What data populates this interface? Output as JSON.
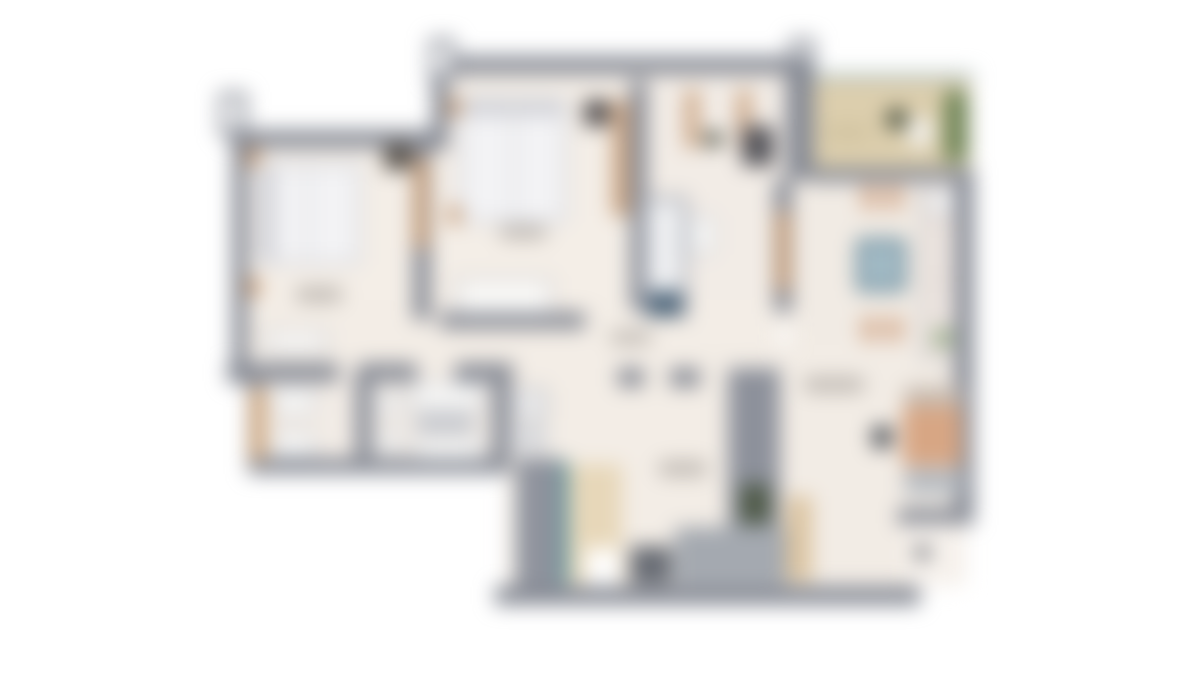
{
  "meta": {
    "description": "Heavily blurred top-down architectural floor plan of an apartment (2 bedrooms, 2 bathrooms, shower room, kitchen-dining, living area, entry hall, balcony). No legible text; room labels appear only as faint smudges.",
    "canvas_width": 1200,
    "canvas_height": 675,
    "background": "#ffffff",
    "blur_px": 10
  },
  "palette": {
    "wall_gray": "#878b95",
    "wall_gray_light": "#a4a9b0",
    "floor_cream": "#f3ede6",
    "balcony_tan": "#dccead",
    "wood_tan": "#c59a74",
    "cabinet_beige": "#e7d7b9",
    "plant_green": "#6d8355",
    "dark_green": "#4f5a48",
    "table_blue": "#6f8fa0",
    "teal_glass": "#4f8f96",
    "sofa_salmon": "#d7a684",
    "fixture_white": "#f7f7f6",
    "label_smudge": "#bdb7b1"
  },
  "floorplan": {
    "regions": [
      {
        "name": "bedroom-1-floor",
        "x": 232,
        "y": 132,
        "w": 200,
        "h": 246,
        "color": "#f4eee7"
      },
      {
        "name": "bedroom-2-floor",
        "x": 432,
        "y": 58,
        "w": 382,
        "h": 268,
        "color": "#f4eee7"
      },
      {
        "name": "shower-room-floor",
        "x": 640,
        "y": 82,
        "w": 150,
        "h": 230,
        "color": "#f2ece6"
      },
      {
        "name": "kitchen-floor",
        "x": 790,
        "y": 168,
        "w": 168,
        "h": 217,
        "color": "#f1ebe4"
      },
      {
        "name": "hallway-floor",
        "x": 246,
        "y": 300,
        "w": 534,
        "h": 85,
        "color": "#f3ede6"
      },
      {
        "name": "bathrooms-floor",
        "x": 250,
        "y": 372,
        "w": 306,
        "h": 100,
        "color": "#f2ece6"
      },
      {
        "name": "utility-floor",
        "x": 505,
        "y": 375,
        "w": 115,
        "h": 212,
        "color": "#f3ede6"
      },
      {
        "name": "entry-hall-floor",
        "x": 560,
        "y": 327,
        "w": 220,
        "h": 260,
        "color": "#f3ede6"
      },
      {
        "name": "living-room-floor",
        "x": 700,
        "y": 345,
        "w": 266,
        "h": 240,
        "color": "#f2ece5"
      },
      {
        "name": "balcony-glass-rail",
        "x": 808,
        "y": 72,
        "w": 166,
        "h": 10,
        "color": "#b8c7c7"
      },
      {
        "name": "balcony-floor",
        "x": 810,
        "y": 80,
        "w": 160,
        "h": 90,
        "color": "#dccead"
      },
      {
        "name": "balcony-plant-strip",
        "x": 944,
        "y": 90,
        "w": 24,
        "h": 72,
        "color": "#6d8355",
        "radius": 8
      },
      {
        "name": "balcony-plant-pot",
        "x": 886,
        "y": 108,
        "w": 22,
        "h": 22,
        "color": "#49513e",
        "radius": "50%"
      },
      {
        "name": "balcony-chair",
        "x": 908,
        "y": 118,
        "w": 24,
        "h": 28,
        "color": "#f2f1ed",
        "radius": 6
      },
      {
        "name": "balcony-label-smudge",
        "x": 826,
        "y": 126,
        "w": 44,
        "h": 13,
        "color": "#cfc19e",
        "radius": 6
      },
      {
        "name": "wall-top-bedroom-1",
        "x": 230,
        "y": 130,
        "w": 206,
        "h": 18,
        "color": "#878b95"
      },
      {
        "name": "wall-left-exterior",
        "x": 232,
        "y": 132,
        "w": 16,
        "h": 252,
        "color": "#878b95"
      },
      {
        "name": "wall-post-top-left",
        "x": 219,
        "y": 92,
        "w": 28,
        "h": 44,
        "color": "#878b95"
      },
      {
        "name": "wall-post-top-left-cap",
        "x": 225,
        "y": 98,
        "w": 15,
        "h": 31,
        "color": "#ffffff"
      },
      {
        "name": "wall-top-bedroom-2",
        "x": 432,
        "y": 56,
        "w": 382,
        "h": 18,
        "color": "#878b95"
      },
      {
        "name": "wall-step-top",
        "x": 432,
        "y": 56,
        "w": 16,
        "h": 94,
        "color": "#878b95"
      },
      {
        "name": "wall-post-top-mid",
        "x": 429,
        "y": 38,
        "w": 26,
        "h": 44,
        "color": "#878b95"
      },
      {
        "name": "wall-post-top-mid-cap",
        "x": 435,
        "y": 44,
        "w": 14,
        "h": 30,
        "color": "#ffffff"
      },
      {
        "name": "wall-post-top-right",
        "x": 789,
        "y": 38,
        "w": 26,
        "h": 44,
        "color": "#878b95"
      },
      {
        "name": "wall-post-top-right-cap",
        "x": 795,
        "y": 44,
        "w": 14,
        "h": 30,
        "color": "#ffffff"
      },
      {
        "name": "wall-block-balcony-left",
        "x": 786,
        "y": 56,
        "w": 28,
        "h": 124,
        "color": "#878b95"
      },
      {
        "name": "wall-under-balcony",
        "x": 810,
        "y": 168,
        "w": 164,
        "h": 14,
        "color": "#878b95"
      },
      {
        "name": "wall-right-kitchen",
        "x": 954,
        "y": 168,
        "w": 20,
        "h": 220,
        "color": "#878b95"
      },
      {
        "name": "wall-bedroom-1-right",
        "x": 413,
        "y": 135,
        "w": 18,
        "h": 185,
        "color": "#878b95"
      },
      {
        "name": "wall-bedroom-2-right",
        "x": 630,
        "y": 80,
        "w": 17,
        "h": 230,
        "color": "#878b95"
      },
      {
        "name": "wall-bedroom-2-bottom",
        "x": 440,
        "y": 312,
        "w": 145,
        "h": 17,
        "color": "#878b95"
      },
      {
        "name": "wall-shower-room-right",
        "x": 774,
        "y": 180,
        "w": 18,
        "h": 132,
        "color": "#878b95"
      },
      {
        "name": "wall-bathrooms-top-a",
        "x": 227,
        "y": 363,
        "w": 112,
        "h": 19,
        "color": "#878b95"
      },
      {
        "name": "wall-bathrooms-top-b",
        "x": 359,
        "y": 363,
        "w": 58,
        "h": 19,
        "color": "#878b95"
      },
      {
        "name": "wall-bathrooms-top-c",
        "x": 455,
        "y": 363,
        "w": 58,
        "h": 19,
        "color": "#878b95"
      },
      {
        "name": "wall-bathrooms-left",
        "x": 248,
        "y": 370,
        "w": 14,
        "h": 104,
        "color": "#878b95"
      },
      {
        "name": "wall-bathroom-divider",
        "x": 355,
        "y": 370,
        "w": 17,
        "h": 100,
        "color": "#878b95"
      },
      {
        "name": "wall-bathroom-2-right",
        "x": 492,
        "y": 370,
        "w": 18,
        "h": 100,
        "color": "#878b95"
      },
      {
        "name": "wall-bathrooms-bottom",
        "x": 248,
        "y": 458,
        "w": 262,
        "h": 16,
        "color": "#878b95"
      },
      {
        "name": "wall-hall-living-a",
        "x": 618,
        "y": 368,
        "w": 26,
        "h": 19,
        "color": "#878b95"
      },
      {
        "name": "wall-hall-living-b",
        "x": 670,
        "y": 368,
        "w": 30,
        "h": 19,
        "color": "#878b95"
      },
      {
        "name": "wall-entry-living-thick",
        "x": 728,
        "y": 368,
        "w": 52,
        "h": 215,
        "color": "#8d919b"
      },
      {
        "name": "stairs-blob",
        "x": 675,
        "y": 527,
        "w": 112,
        "h": 58,
        "color": "#a4a9b0"
      },
      {
        "name": "duct-shaft",
        "x": 516,
        "y": 458,
        "w": 46,
        "h": 130,
        "color": "#8f939d"
      },
      {
        "name": "wall-bottom-main",
        "x": 495,
        "y": 586,
        "w": 425,
        "h": 19,
        "color": "#878b95"
      },
      {
        "name": "wall-living-right",
        "x": 954,
        "y": 385,
        "w": 20,
        "h": 140,
        "color": "#878b95"
      },
      {
        "name": "wall-living-bottom-right",
        "x": 898,
        "y": 508,
        "w": 76,
        "h": 17,
        "color": "#878b95"
      },
      {
        "name": "living-notch-floor",
        "x": 904,
        "y": 524,
        "w": 60,
        "h": 62,
        "color": "#f6f1ec"
      },
      {
        "name": "bed-1",
        "x": 256,
        "y": 162,
        "w": 106,
        "h": 104,
        "color": "#dcdde1",
        "radius": 6
      },
      {
        "name": "bed-1-duvet",
        "x": 262,
        "y": 168,
        "w": 94,
        "h": 92,
        "color": "#f3f3f5"
      },
      {
        "name": "bed-1-pillow-band",
        "x": 262,
        "y": 168,
        "w": 13,
        "h": 92,
        "color": "#cfd0d6"
      },
      {
        "name": "bed-1-center-seam",
        "x": 306,
        "y": 168,
        "w": 3,
        "h": 92,
        "color": "#d5d6da"
      },
      {
        "name": "nightstand-1a",
        "x": 246,
        "y": 148,
        "w": 14,
        "h": 18,
        "color": "#c59a74"
      },
      {
        "name": "nightstand-1b",
        "x": 246,
        "y": 278,
        "w": 14,
        "h": 18,
        "color": "#c59a74"
      },
      {
        "name": "wardrobe-1-dark",
        "x": 384,
        "y": 144,
        "w": 28,
        "h": 26,
        "color": "#5a544d"
      },
      {
        "name": "door-1-leaf",
        "x": 414,
        "y": 158,
        "w": 14,
        "h": 90,
        "color": "#c59a74"
      },
      {
        "name": "bedroom-1-label-smudge",
        "x": 295,
        "y": 287,
        "w": 48,
        "h": 15,
        "color": "#bdb7b1",
        "radius": 8
      },
      {
        "name": "dresser-1",
        "x": 265,
        "y": 330,
        "w": 62,
        "h": 22,
        "color": "#fbfaf8",
        "border": "2px solid #a9acb4"
      },
      {
        "name": "bed-2",
        "x": 458,
        "y": 96,
        "w": 110,
        "h": 128,
        "color": "#dcdde1",
        "radius": 6
      },
      {
        "name": "bed-2-duvet",
        "x": 464,
        "y": 102,
        "w": 98,
        "h": 116,
        "color": "#f3f3f5"
      },
      {
        "name": "bed-2-pillow-band",
        "x": 464,
        "y": 102,
        "w": 98,
        "h": 14,
        "color": "#cfd0d6"
      },
      {
        "name": "bed-2-center-seam",
        "x": 512,
        "y": 102,
        "w": 3,
        "h": 116,
        "color": "#d5d6da"
      },
      {
        "name": "nightstand-2a",
        "x": 448,
        "y": 98,
        "w": 13,
        "h": 18,
        "color": "#c59a74"
      },
      {
        "name": "nightstand-2b",
        "x": 448,
        "y": 206,
        "w": 13,
        "h": 18,
        "color": "#c59a74"
      },
      {
        "name": "media-unit-2-dark",
        "x": 584,
        "y": 100,
        "w": 26,
        "h": 26,
        "color": "#545051"
      },
      {
        "name": "wardrobe-2-wood",
        "x": 612,
        "y": 100,
        "w": 18,
        "h": 116,
        "color": "#caa584"
      },
      {
        "name": "bedroom-2-label-smudge",
        "x": 499,
        "y": 225,
        "w": 48,
        "h": 14,
        "color": "#bdb7b1",
        "radius": 8
      },
      {
        "name": "dresser-2",
        "x": 456,
        "y": 278,
        "w": 96,
        "h": 36,
        "color": "#faf9f7",
        "border": "2px solid #a9acb4"
      },
      {
        "name": "door-frame-shower-a",
        "x": 686,
        "y": 90,
        "w": 12,
        "h": 58,
        "color": "#c59a74"
      },
      {
        "name": "door-frame-shower-b",
        "x": 738,
        "y": 90,
        "w": 12,
        "h": 58,
        "color": "#c59a74"
      },
      {
        "name": "wc-dark-dot",
        "x": 704,
        "y": 132,
        "w": 18,
        "h": 14,
        "color": "#4b4f42"
      },
      {
        "name": "desk-dark",
        "x": 742,
        "y": 126,
        "w": 32,
        "h": 40,
        "color": "#56565c"
      },
      {
        "name": "shower-enclosure",
        "x": 642,
        "y": 196,
        "w": 46,
        "h": 122,
        "color": "#a9adb6"
      },
      {
        "name": "shower-tray",
        "x": 648,
        "y": 202,
        "w": 34,
        "h": 88,
        "color": "#eff0f2"
      },
      {
        "name": "shower-base-dark",
        "x": 648,
        "y": 292,
        "w": 34,
        "h": 24,
        "color": "#4a6378"
      },
      {
        "name": "toilet-shower-room",
        "x": 688,
        "y": 214,
        "w": 28,
        "h": 42,
        "color": "#f7f7f6",
        "radius": 10,
        "border": "2px solid #b3b7bf"
      },
      {
        "name": "door-leaf-shower-room",
        "x": 776,
        "y": 212,
        "w": 14,
        "h": 78,
        "color": "#c59a74"
      },
      {
        "name": "dining-chair-top-a",
        "x": 861,
        "y": 184,
        "w": 18,
        "h": 26,
        "color": "#d8b49a",
        "radius": 5
      },
      {
        "name": "dining-chair-top-b",
        "x": 885,
        "y": 184,
        "w": 18,
        "h": 26,
        "color": "#d8b49a",
        "radius": 5
      },
      {
        "name": "dining-table-blue",
        "x": 856,
        "y": 238,
        "w": 50,
        "h": 54,
        "color": "#6f8fa0",
        "radius": 4
      },
      {
        "name": "dining-table-blue-top",
        "x": 863,
        "y": 245,
        "w": 36,
        "h": 40,
        "color": "#a4bcc6"
      },
      {
        "name": "dining-chair-bottom-a",
        "x": 861,
        "y": 316,
        "w": 18,
        "h": 26,
        "color": "#d8b49a",
        "radius": 5
      },
      {
        "name": "dining-chair-bottom-b",
        "x": 885,
        "y": 316,
        "w": 18,
        "h": 26,
        "color": "#d8b49a",
        "radius": 5
      },
      {
        "name": "kitchen-counter-column",
        "x": 920,
        "y": 180,
        "w": 36,
        "h": 180,
        "color": "#e9e1dc",
        "border": "2px solid #b4b8bf"
      },
      {
        "name": "kitchen-sink",
        "x": 928,
        "y": 190,
        "w": 26,
        "h": 24,
        "color": "#fafafa",
        "radius": 6,
        "border": "2px solid #aeb2ba"
      },
      {
        "name": "kitchen-cabinet-a",
        "x": 928,
        "y": 230,
        "w": 26,
        "h": 42,
        "color": "#ece4df",
        "radius": 4
      },
      {
        "name": "kitchen-cabinet-b",
        "x": 928,
        "y": 286,
        "w": 26,
        "h": 36,
        "color": "#ece4df",
        "radius": 4
      },
      {
        "name": "kitchen-plant-dot",
        "x": 932,
        "y": 328,
        "w": 22,
        "h": 20,
        "color": "#9fb28e",
        "radius": "50%"
      },
      {
        "name": "bathroom-1-cabinet-wood",
        "x": 250,
        "y": 388,
        "w": 16,
        "h": 72,
        "color": "#d0a87f"
      },
      {
        "name": "bathroom-1-toilet",
        "x": 272,
        "y": 387,
        "w": 44,
        "h": 28,
        "color": "#f7f7f6",
        "radius": 9,
        "border": "2px solid #b0b4bc"
      },
      {
        "name": "bathroom-1-sink",
        "x": 272,
        "y": 432,
        "w": 44,
        "h": 26,
        "color": "#f7f7f6",
        "radius": 6,
        "border": "2px solid #b0b4bc"
      },
      {
        "name": "bathroom-2-fixture-a",
        "x": 376,
        "y": 392,
        "w": 26,
        "h": 24,
        "color": "#f3f2f0",
        "border": "2px solid #b7bbc2"
      },
      {
        "name": "bathroom-2-fixture-b",
        "x": 376,
        "y": 430,
        "w": 26,
        "h": 24,
        "color": "#f3f2f0",
        "border": "2px solid #b7bbc2"
      },
      {
        "name": "bathroom-2-vanity",
        "x": 412,
        "y": 382,
        "w": 70,
        "h": 28,
        "color": "#f8f8f7",
        "radius": 4,
        "border": "2px solid #b0b4bc"
      },
      {
        "name": "bathroom-2-tub",
        "x": 414,
        "y": 412,
        "w": 62,
        "h": 22,
        "color": "#c9cbd0",
        "radius": 10
      },
      {
        "name": "bathroom-2-sink",
        "x": 415,
        "y": 438,
        "w": 66,
        "h": 22,
        "color": "#f8f8f7",
        "radius": 4,
        "border": "2px solid #b0b4bc"
      },
      {
        "name": "washer",
        "x": 512,
        "y": 388,
        "w": 36,
        "h": 32,
        "color": "#e9e9eb",
        "radius": 4,
        "border": "2px solid #9aa0a8"
      },
      {
        "name": "dryer",
        "x": 512,
        "y": 424,
        "w": 36,
        "h": 30,
        "color": "#d9dadd",
        "radius": 4
      },
      {
        "name": "entry-glass-door-teal",
        "x": 560,
        "y": 462,
        "w": 8,
        "h": 122,
        "color": "#4f8f96"
      },
      {
        "name": "entry-wardrobe-beige",
        "x": 570,
        "y": 464,
        "w": 52,
        "h": 120,
        "color": "#e7d7b9"
      },
      {
        "name": "entry-door-gap",
        "x": 586,
        "y": 548,
        "w": 32,
        "h": 38,
        "color": "#ffffff"
      },
      {
        "name": "entrance-door-leaf",
        "x": 630,
        "y": 546,
        "w": 42,
        "h": 38,
        "color": "#686c74"
      },
      {
        "name": "entry-closet-green",
        "x": 740,
        "y": 484,
        "w": 30,
        "h": 40,
        "color": "#4f5a48"
      },
      {
        "name": "hall-label-smudge",
        "x": 610,
        "y": 331,
        "w": 42,
        "h": 13,
        "color": "#bdb7b1",
        "radius": 8
      },
      {
        "name": "entry-label-smudge",
        "x": 658,
        "y": 461,
        "w": 50,
        "h": 15,
        "color": "#bdb7b1",
        "radius": 8
      },
      {
        "name": "living-label-smudge",
        "x": 803,
        "y": 377,
        "w": 62,
        "h": 15,
        "color": "#bdb7b1",
        "radius": 8
      },
      {
        "name": "living-cabinet-wood",
        "x": 786,
        "y": 496,
        "w": 26,
        "h": 86,
        "color": "#dcc5a2"
      },
      {
        "name": "sofa-back-section",
        "x": 904,
        "y": 386,
        "w": 58,
        "h": 20,
        "color": "#c8bdb3",
        "radius": 4
      },
      {
        "name": "sofa-main",
        "x": 902,
        "y": 406,
        "w": 60,
        "h": 60,
        "color": "#d7a684",
        "radius": 6
      },
      {
        "name": "sofa-chaise-section",
        "x": 904,
        "y": 468,
        "w": 58,
        "h": 26,
        "color": "#b6bbc1",
        "radius": 4
      },
      {
        "name": "coffee-table-dark",
        "x": 872,
        "y": 426,
        "w": 20,
        "h": 22,
        "color": "#4e5258",
        "radius": 4
      },
      {
        "name": "living-dark-dot",
        "x": 916,
        "y": 546,
        "w": 13,
        "h": 13,
        "color": "#5a5e66"
      }
    ]
  }
}
